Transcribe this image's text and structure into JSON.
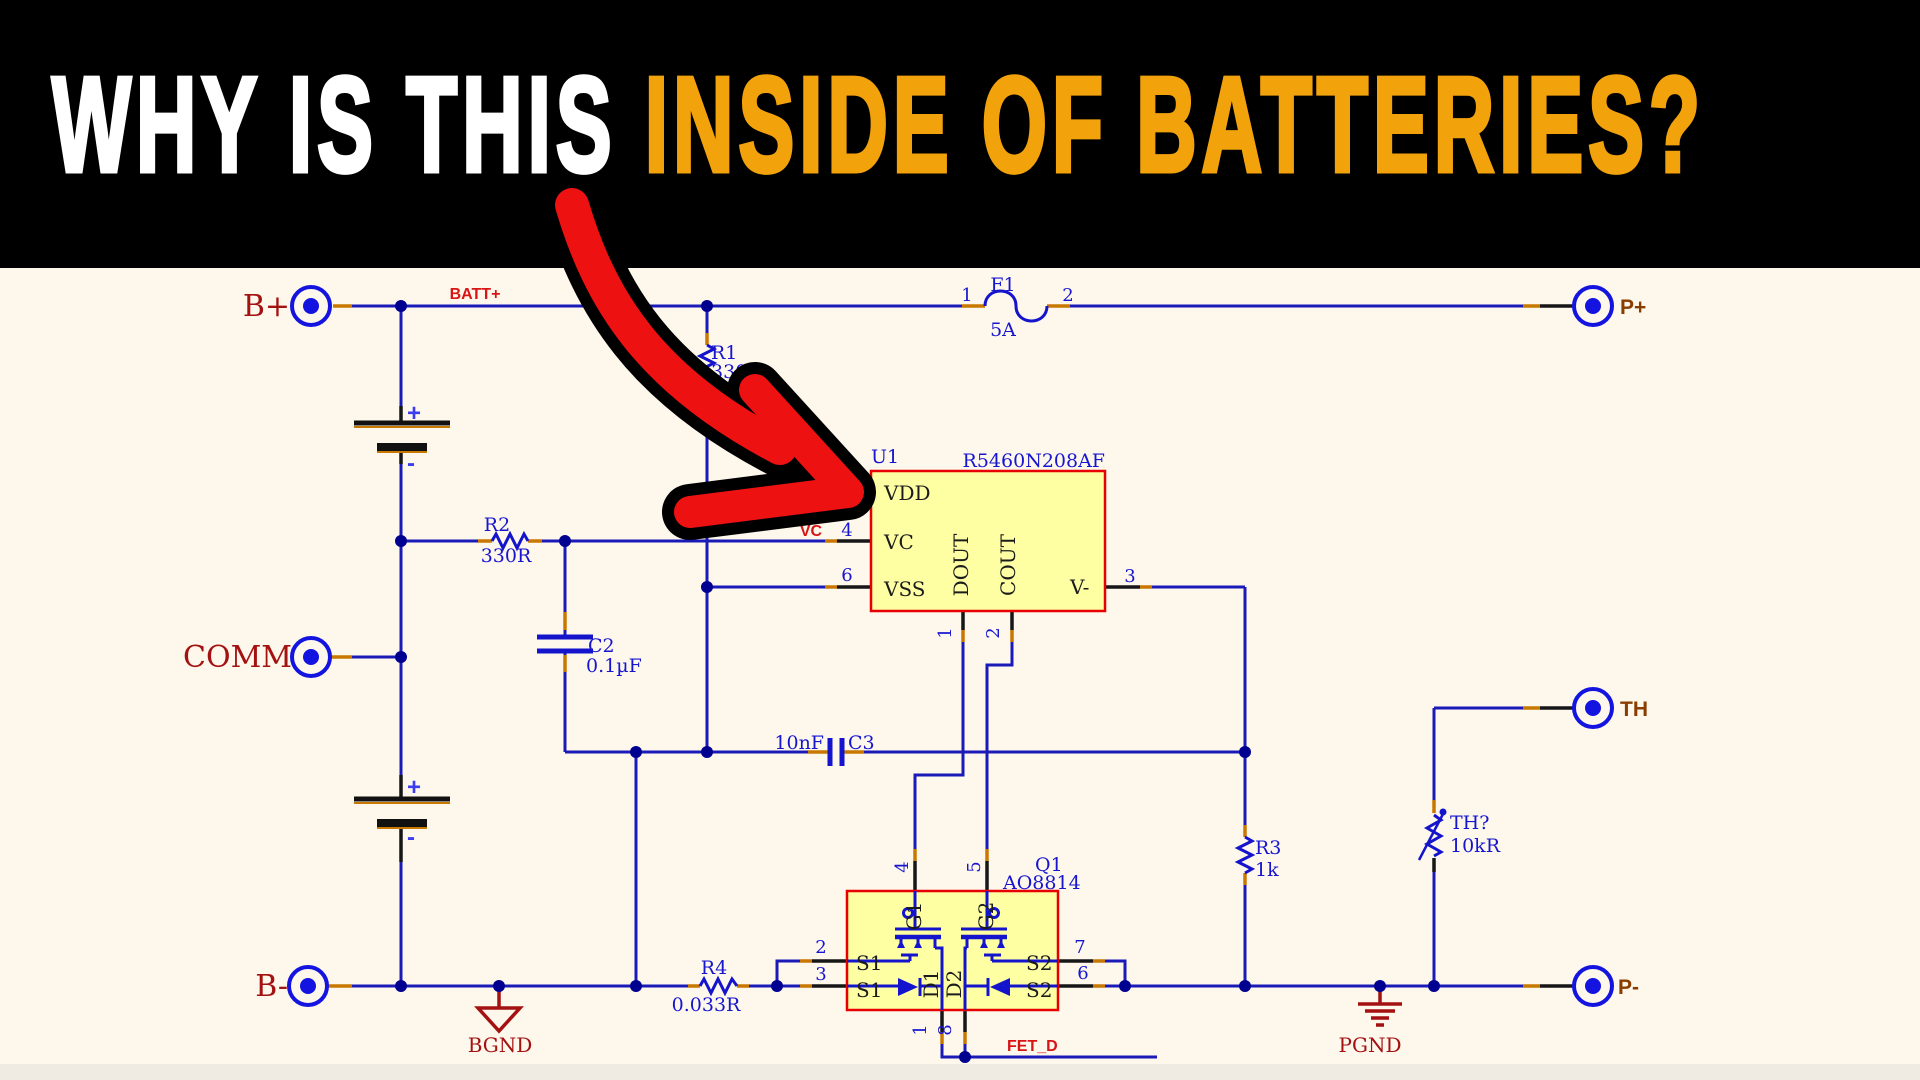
{
  "banner": {
    "title_white": "WHY IS THIS",
    "title_orange": "INSIDE OF BATTERIES?"
  },
  "colors": {
    "background": "#FDF7EC",
    "banner": "#000000",
    "title_white": "#FFFFFF",
    "title_orange": "#F2A20A",
    "wire": "#1a1ab8",
    "component": "#1414cc",
    "junction": "#000090",
    "box_fill": "#FEFFA3",
    "box_border": "#E80000",
    "pin_black": "#161616",
    "pin_orange": "#C87800",
    "net_label_red": "#D81414",
    "terminal_dark_red": "#A31111",
    "port_brown": "#8A3D00",
    "arrow_red": "#EE1111",
    "arrow_outline": "#000000"
  },
  "terminals": {
    "b_plus": "B+",
    "comm": "COMM",
    "b_minus": "B-"
  },
  "ports": {
    "p_plus": "P+",
    "th": "TH",
    "p_minus": "P-"
  },
  "nets": {
    "batt_plus": "BATT+",
    "vc": "VC",
    "fet_d": "FET_D"
  },
  "grounds": {
    "bgnd": "BGND",
    "pgnd": "PGND"
  },
  "f1": {
    "ref": "F1",
    "value": "5A",
    "pin1": "1",
    "pin2": "2"
  },
  "r1": {
    "ref": "R1",
    "value": "330R"
  },
  "r2": {
    "ref": "R2",
    "value": "330R"
  },
  "r3": {
    "ref": "R3",
    "value": "1k"
  },
  "r4": {
    "ref": "R4",
    "value": "0.033R"
  },
  "c2": {
    "ref": "C2",
    "value": "0.1µF"
  },
  "c3": {
    "ref": "C3",
    "value": "10nF"
  },
  "th_r": {
    "ref": "TH?",
    "value": "10kR"
  },
  "bat1": {
    "plus": "+",
    "minus": "-"
  },
  "bat2": {
    "plus": "+",
    "minus": "-"
  },
  "u1": {
    "ref": "U1",
    "part": "R5460N208AF",
    "pin_vdd": "VDD",
    "pin_vc": "VC",
    "pin_vss": "VSS",
    "pin_dout": "DOUT",
    "pin_cout": "COUT",
    "pin_vminus": "V-",
    "num_vc": "4",
    "num_vss": "6",
    "num_vminus": "3",
    "num_dout": "1",
    "num_cout": "2"
  },
  "q1": {
    "ref": "Q1",
    "part": "AO8814",
    "s1": "S1",
    "s2": "S2",
    "g1": "G1",
    "g2": "G2",
    "d1": "D1",
    "d2": "D2",
    "num_g1": "4",
    "num_g2": "5",
    "num_s1_top": "2",
    "num_s1_bot": "3",
    "num_s2_top": "7",
    "num_s2_bot": "6",
    "num_d1": "1",
    "num_d2": "8"
  }
}
